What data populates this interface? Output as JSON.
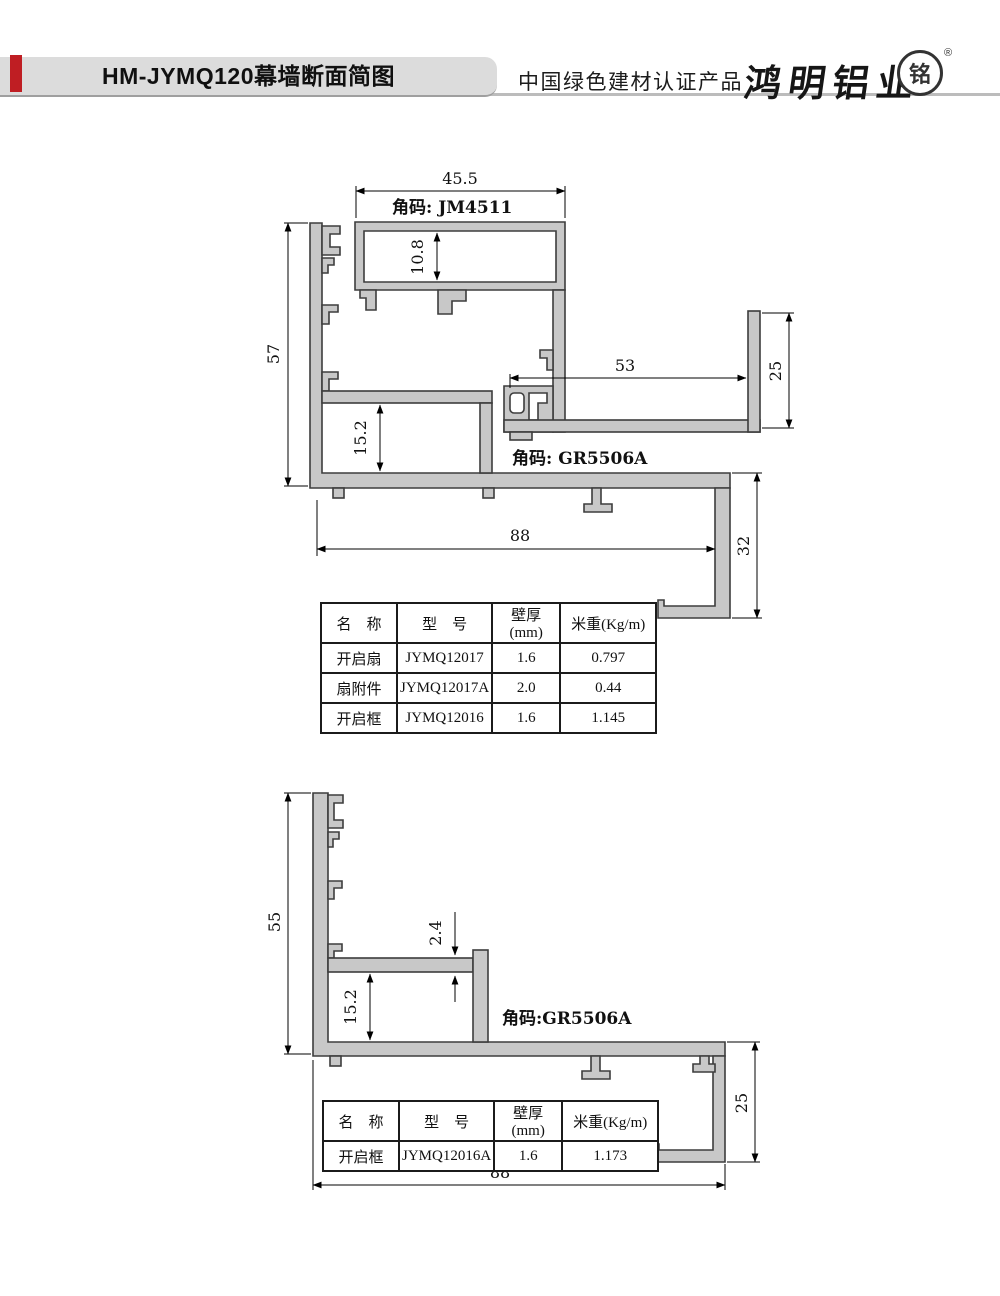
{
  "header": {
    "title": "HM-JYMQ120幕墙断面简图",
    "cert_label": "中国绿色建材认证产品",
    "brand_name": "鸿明铝业",
    "seal_char": "铭",
    "registered_mark": "®",
    "accent_color": "#bf1e23",
    "banner_color": "#dcdcdc"
  },
  "diagram1": {
    "corner_code_top_label": "角码: JM4511",
    "corner_code_side_label": "角码: GR5506A",
    "dim_top_width": "45.5",
    "dim_cavity_height": "10.8",
    "dim_left_height": "57",
    "dim_shelf_width": "53",
    "dim_right_upper_height": "25",
    "dim_box_height": "15.2",
    "dim_bottom_width": "88",
    "dim_right_lower_height": "32"
  },
  "diagram2": {
    "corner_code_label": "角码:GR5506A",
    "dim_left_height": "55",
    "dim_lip_thickness": "2.4",
    "dim_box_height": "15.2",
    "dim_right_height": "25",
    "dim_bottom_width": "88"
  },
  "table1": {
    "headers": [
      "名　称",
      "型　号",
      "壁厚(mm)",
      "米重(Kg/m)"
    ],
    "rows": [
      [
        "开启扇",
        "JYMQ12017",
        "1.6",
        "0.797"
      ],
      [
        "扇附件",
        "JYMQ12017A",
        "2.0",
        "0.44"
      ],
      [
        "开启框",
        "JYMQ12016",
        "1.6",
        "1.145"
      ]
    ]
  },
  "table2": {
    "headers": [
      "名　称",
      "型　号",
      "壁厚(mm)",
      "米重(Kg/m)"
    ],
    "rows": [
      [
        "开启框",
        "JYMQ12016A",
        "1.6",
        "1.173"
      ]
    ]
  }
}
